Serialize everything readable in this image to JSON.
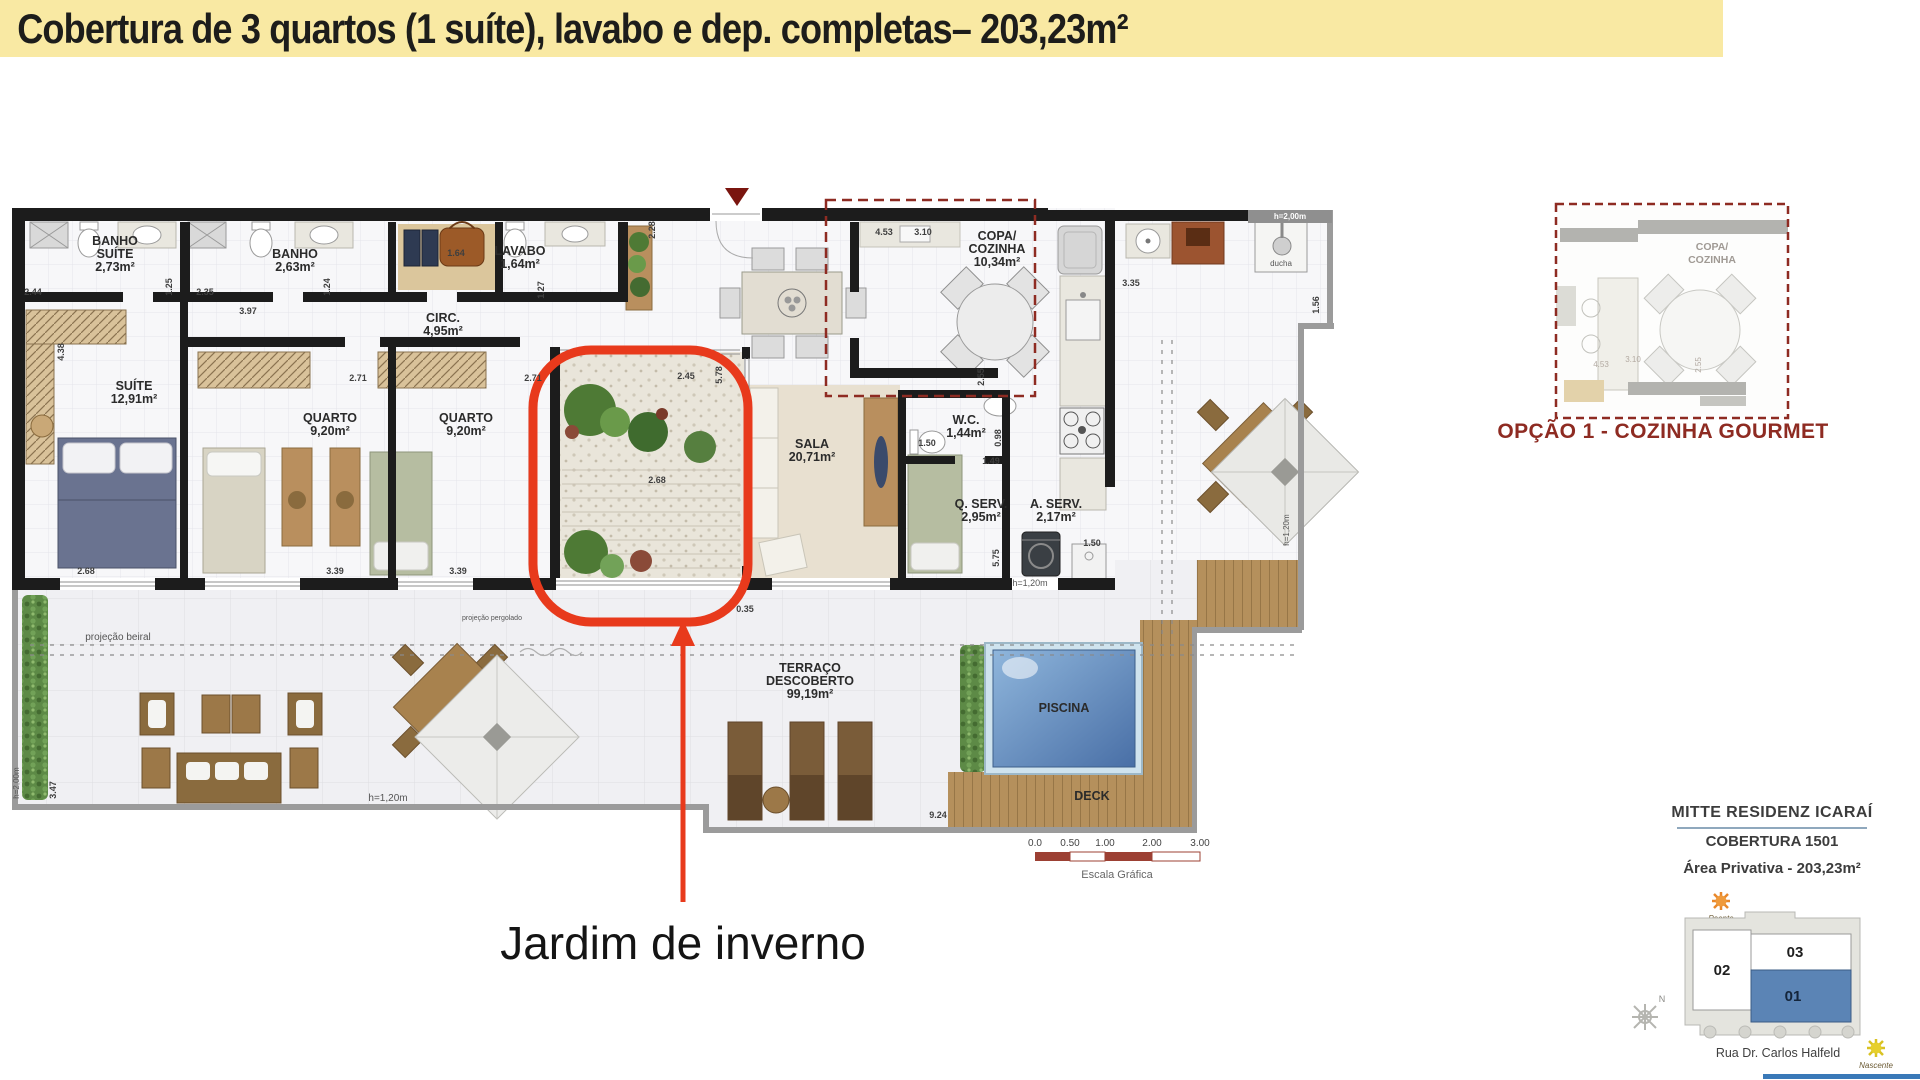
{
  "header": {
    "title": "Cobertura de 3 quartos (1 suíte), lavabo e dep. completas– 203,23m²"
  },
  "callout": {
    "label": "Jardim de inverno"
  },
  "colors": {
    "banner_bg": "#F9E9A3",
    "highlight_red": "#E83A1C",
    "option_dark_red": "#8E2B22",
    "pool_blue": "#5E8FC4",
    "unit_blue": "#5b84b5",
    "scale_red": "#9C4033"
  },
  "plan": {
    "rooms": [
      {
        "name": "BANHO\nSUÍTE",
        "area": "2,73m²",
        "x": 115,
        "y": 245
      },
      {
        "name": "BANHO",
        "area": "2,63m²",
        "x": 295,
        "y": 258
      },
      {
        "name": "LAVABO",
        "area": "1,64m²",
        "x": 520,
        "y": 255
      },
      {
        "name": "CIRC.",
        "area": "4,95m²",
        "x": 443,
        "y": 322
      },
      {
        "name": "SUÍTE",
        "area": "12,91m²",
        "x": 134,
        "y": 390
      },
      {
        "name": "QUARTO",
        "area": "9,20m²",
        "x": 330,
        "y": 422
      },
      {
        "name": "QUARTO",
        "area": "9,20m²",
        "x": 466,
        "y": 422
      },
      {
        "name": "SALA",
        "area": "20,71m²",
        "x": 812,
        "y": 448
      },
      {
        "name": "COPA/\nCOZINHA",
        "area": "10,34m²",
        "x": 997,
        "y": 240
      },
      {
        "name": "W.C.",
        "area": "1,44m²",
        "x": 966,
        "y": 424
      },
      {
        "name": "Q. SERV.",
        "area": "2,95m²",
        "x": 981,
        "y": 508
      },
      {
        "name": "A. SERV.",
        "area": "2,17m²",
        "x": 1056,
        "y": 508
      },
      {
        "name": "TERRAÇO\nDESCOBERTO",
        "area": "99,19m²",
        "x": 810,
        "y": 672
      },
      {
        "name": "PISCINA",
        "x": 1064,
        "y": 712
      },
      {
        "name": "DECK",
        "x": 1092,
        "y": 800
      }
    ],
    "dimensions": [
      {
        "t": "2.44",
        "x": 33,
        "y": 295
      },
      {
        "t": "2.35",
        "x": 205,
        "y": 295
      },
      {
        "t": "3.97",
        "x": 248,
        "y": 314
      },
      {
        "t": "1.25",
        "x": 172,
        "y": 287,
        "v": 1
      },
      {
        "t": "1.24",
        "x": 330,
        "y": 287,
        "v": 1
      },
      {
        "t": "1.64",
        "x": 456,
        "y": 256
      },
      {
        "t": "1.27",
        "x": 544,
        "y": 290,
        "v": 1
      },
      {
        "t": "4.38",
        "x": 64,
        "y": 352,
        "v": 1
      },
      {
        "t": "2.71",
        "x": 358,
        "y": 381
      },
      {
        "t": "2.71",
        "x": 533,
        "y": 381
      },
      {
        "t": "2.45",
        "x": 686,
        "y": 379
      },
      {
        "t": "5.78",
        "x": 722,
        "y": 375,
        "v": 1
      },
      {
        "t": "2.28",
        "x": 655,
        "y": 230,
        "v": 1
      },
      {
        "t": "4.53",
        "x": 884,
        "y": 235
      },
      {
        "t": "3.10",
        "x": 923,
        "y": 235
      },
      {
        "t": "2.55",
        "x": 984,
        "y": 377,
        "v": 1
      },
      {
        "t": "1.50",
        "x": 927,
        "y": 446
      },
      {
        "t": "1.49",
        "x": 991,
        "y": 464
      },
      {
        "t": "0.98",
        "x": 1001,
        "y": 438,
        "v": 1
      },
      {
        "t": "3.35",
        "x": 1131,
        "y": 286
      },
      {
        "t": "1.56",
        "x": 1319,
        "y": 305,
        "v": 1
      },
      {
        "t": "5.75",
        "x": 999,
        "y": 558,
        "v": 1
      },
      {
        "t": "1.50",
        "x": 1092,
        "y": 546
      },
      {
        "t": "2.68",
        "x": 86,
        "y": 574
      },
      {
        "t": "3.39",
        "x": 335,
        "y": 574
      },
      {
        "t": "3.39",
        "x": 458,
        "y": 574
      },
      {
        "t": "2.68",
        "x": 657,
        "y": 483
      },
      {
        "t": "0.35",
        "x": 745,
        "y": 612
      },
      {
        "t": "9.24",
        "x": 938,
        "y": 818
      },
      {
        "t": "3.47",
        "x": 56,
        "y": 790,
        "v": 1
      }
    ],
    "small_labels": [
      {
        "t": "ducha",
        "x": 1281,
        "y": 266,
        "s": 8
      },
      {
        "t": "h=2,00m",
        "x": 1290,
        "y": 219,
        "s": 8,
        "c": "wht"
      },
      {
        "t": "h=1,20m",
        "x": 1030,
        "y": 586,
        "s": 9
      },
      {
        "t": "h=1,20m",
        "x": 388,
        "y": 801,
        "s": 10
      },
      {
        "t": "h=1,20m",
        "x": 1289,
        "y": 530,
        "s": 8,
        "v": 1
      },
      {
        "t": "h=2,00m",
        "x": 19,
        "y": 783,
        "s": 8,
        "v": 1
      },
      {
        "t": "projeção beiral",
        "x": 118,
        "y": 640,
        "s": 10
      },
      {
        "t": "projeção pergolado",
        "x": 492,
        "y": 620,
        "s": 7
      }
    ],
    "scale": {
      "ticks": [
        "0.0",
        "0.50",
        "1.00",
        "2.00",
        "3.00"
      ],
      "xs": [
        1035,
        1070,
        1105,
        1152,
        1200
      ],
      "label": "Escala Gráfica"
    }
  },
  "inset": {
    "labels": [
      {
        "t": "COPA/\nCOZINHA",
        "x": 1712,
        "y": 250
      }
    ],
    "dims": [
      {
        "t": "4.53",
        "x": 1601,
        "y": 367
      },
      {
        "t": "3.10",
        "x": 1633,
        "y": 362
      },
      {
        "t": "2.55",
        "x": 1701,
        "y": 365,
        "v": 1
      }
    ],
    "caption": "OPÇÃO 1 - COZINHA GOURMET"
  },
  "info": {
    "project": "MITTE RESIDENZ ICARAÍ",
    "unit": "COBERTURA 1501",
    "area": "Área Privativa - 203,23m²",
    "street": "Rua Dr. Carlos Halfeld",
    "unit01": "01",
    "unit02": "02",
    "unit03": "03",
    "poente": "Poente",
    "nascente": "Nascente",
    "north": "N"
  }
}
